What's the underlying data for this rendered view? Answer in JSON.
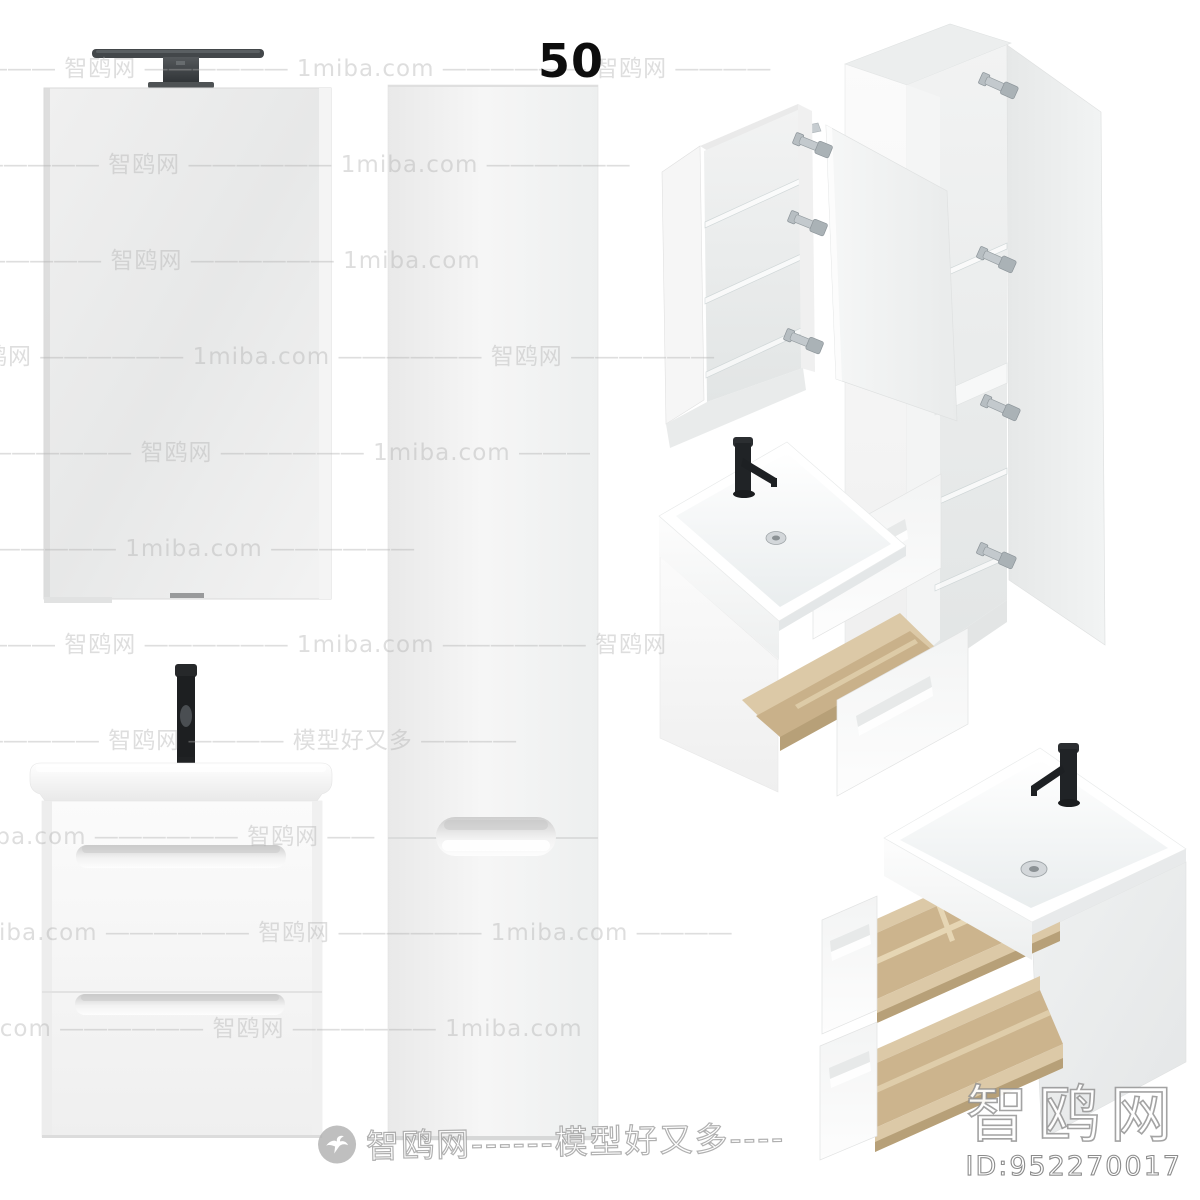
{
  "size_label": "50",
  "watermark": {
    "brand_cn": "智鸥网",
    "site": "1miba.com",
    "tagline": "模型好又多",
    "rows": [
      "―――― 智鸥网 ―――――― 1miba.com ―――――― 智鸥网 ――――",
      "1miba.com ―――――― 智鸥网 ―――――― 1miba.com ――――――",
      "―――――― 1miba.com ―――――― 智鸥网 ―――――― 1miba.com",
      "智鸥网 ―――――― 1miba.com ―――――― 智鸥网 ――――――",
      "― 1miba.com ―――――― 智鸥网 ―――――― 1miba.com ―――",
      "智鸥网 ―――― 模型好又多 ―――――― 1miba.com ――――――",
      "―――― 智鸥网 ―――――― 1miba.com ―――――― 智鸥网",
      "1miba.com ―――――― 智鸥网 ―――― 模型好又多 ――――",
      "―― 智鸥网 ―――――― 1miba.com ―――――― 智鸥网 ――",
      "1miba.com ―――――― 智鸥网 ―――――― 1miba.com ――――",
      "―――― 1miba.com ―――――― 智鸥网 ―――――― 1miba.com"
    ],
    "footer_logo_icon": "seagull-icon",
    "footer_text": "智鸥网------模型好又多----",
    "corner_brand": "智鸥网",
    "corner_id": "ID:952270017"
  },
  "colors": {
    "background": "#ffffff",
    "panel_white": "#fafafa",
    "panel_gray": "#e9ebeb",
    "wood_light": "#dcc9a7",
    "wood_dark": "#c9b18a",
    "faucet_black": "#202326",
    "chrome": "#c3c9cd",
    "watermark_gray": "#aeaeae",
    "label_black": "#0d0d0d"
  }
}
